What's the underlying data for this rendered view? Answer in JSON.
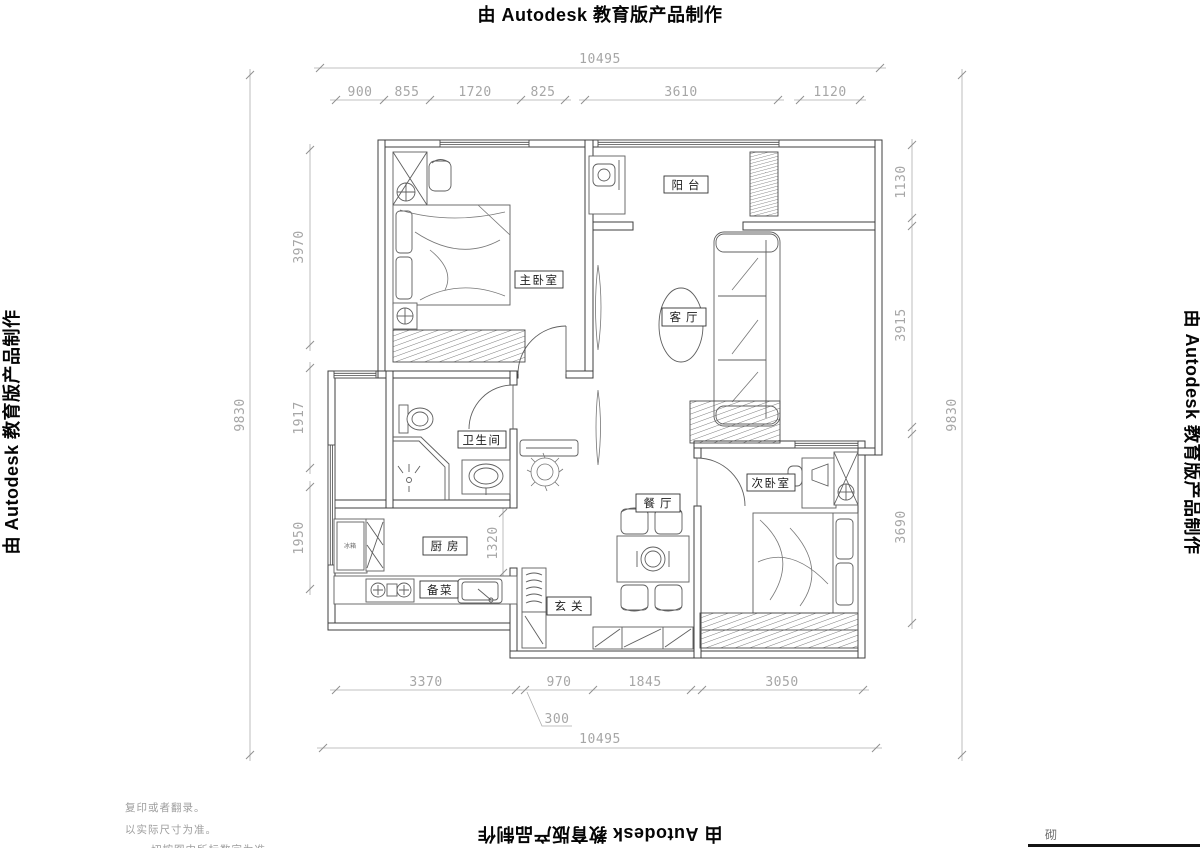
{
  "banner": {
    "text": "由 Autodesk 教育版产品制作"
  },
  "dims": {
    "top": {
      "overall": "10495",
      "segments": [
        "900",
        "855",
        "1720",
        "825",
        "3610",
        "1120"
      ]
    },
    "bottom": {
      "overall": "10495",
      "segments": [
        "3370",
        "970",
        "1845",
        "3050"
      ],
      "offset_note": "300"
    },
    "left": {
      "overall": "9830",
      "segments": [
        "3970",
        "1917",
        "1950"
      ]
    },
    "right": {
      "overall": "9830",
      "segments": [
        "1130",
        "3915",
        "3690"
      ]
    },
    "interior": {
      "hall_width": "1320"
    }
  },
  "rooms": {
    "master_bedroom": "主卧室",
    "balcony": "阳台",
    "living_room": "客厅",
    "bathroom": "卫生间",
    "kitchen": "厨房",
    "prep_area": "备菜",
    "entry": "玄关",
    "dining_room": "餐厅",
    "second_bedroom": "次卧室",
    "fridge_label": "冰箱"
  },
  "notes": {
    "line1": "复印或者翻录。",
    "line2": "以实际尺寸为准。",
    "line3": "、一切按图中所标数字为准。"
  },
  "title_block": {
    "fragment": "砌"
  }
}
